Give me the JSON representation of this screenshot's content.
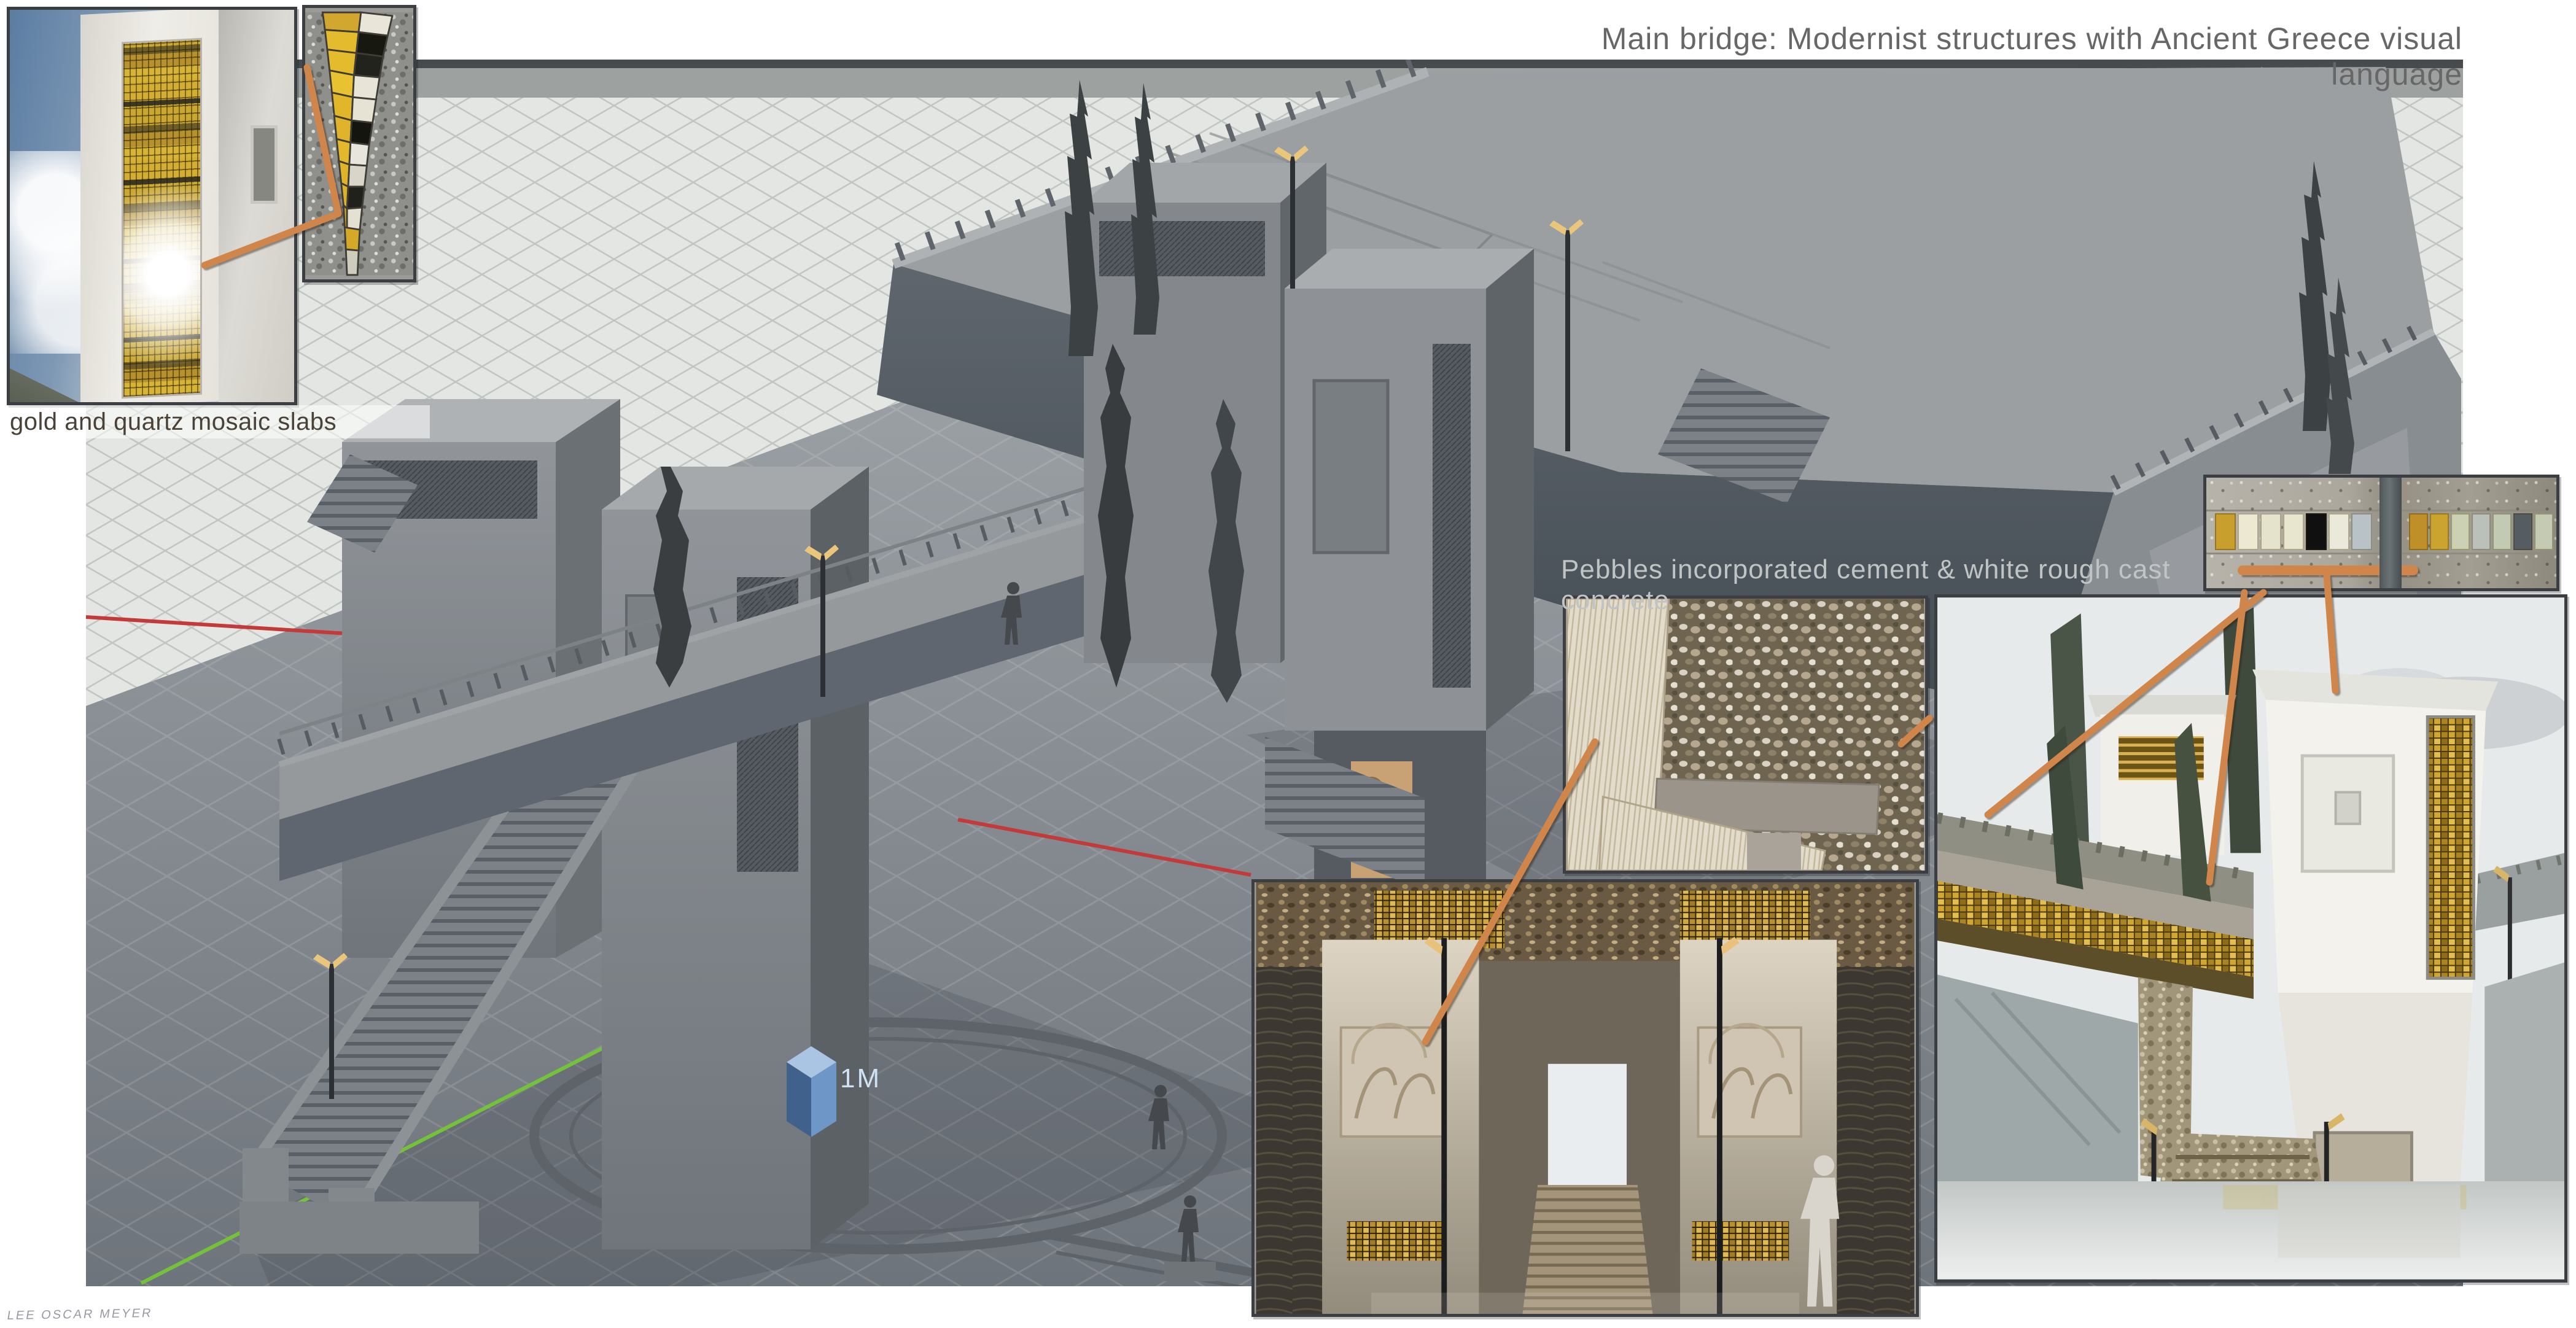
{
  "board": {
    "title": "Main bridge: Modernist structures with Ancient Greece visual language",
    "scale_label": "1M",
    "signature": "LEE OSCAR MEYER"
  },
  "captions": {
    "mosaic_inset": "gold and quartz mosaic slabs",
    "concrete_note": "Pebbles incorporated cement & white rough cast concrete"
  },
  "palette": {
    "left_group": [
      "#c89f2d",
      "#ece8d2",
      "#e6e3cd",
      "#e9e6d0",
      "#101010",
      "#ebe9d9",
      "#b9c3c7"
    ],
    "right_group": [
      "#bf9029",
      "#cba42f",
      "#ccd1b3",
      "#bac0ba",
      "#c2cab4",
      "#555d63",
      "#c5cbb2"
    ]
  },
  "icons": {
    "annotation_marker": "copper-pointer-line",
    "scale_marker": "blue-unit-cube"
  },
  "colors": {
    "page_bg": "#ffffff",
    "title_text": "#676767",
    "caption_dark_text": "#4a4238",
    "caption_light_text": "#c0c4c4",
    "signature_text": "#8b8696",
    "inset_border": "#3b3f43",
    "annotation_copper": "#d0864a",
    "gold_tile": "#d2a72f",
    "axis_x": "#c23a3a",
    "axis_y": "#74c13c",
    "cube_top": "#a9c5e3",
    "cube_left": "#3f618c",
    "cube_right": "#6e96c6",
    "scale_label_text": "#cfe2f4"
  }
}
